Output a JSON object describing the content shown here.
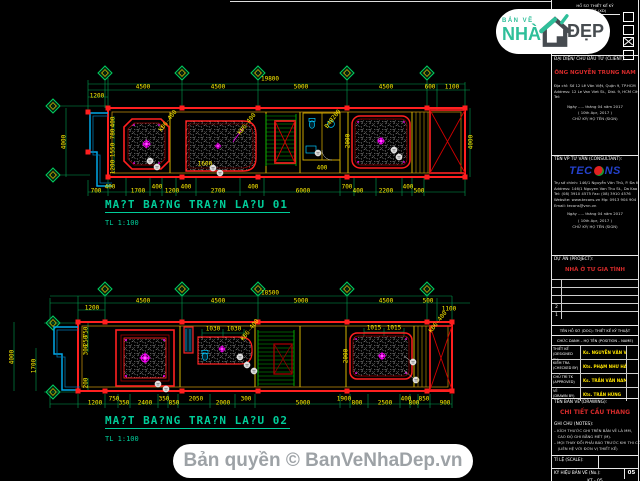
{
  "page": {
    "background": "#000000"
  },
  "colors": {
    "dim_text": "#ffef00",
    "outline_red": "#ff2020",
    "wall_yellow": "#c8a200",
    "axis_green": "#00a050",
    "title_teal": "#00cc99",
    "ornament_magenta": "#ff00ff",
    "client_red": "#d42a2a",
    "name_yellow": "#ffe400",
    "blue_cyan": "#00a8e8"
  },
  "brand": {
    "tagline": "BẢN VẼ",
    "word1": "NHÀ",
    "word2": "ĐẸP",
    "icon": "house-icon"
  },
  "banner": {
    "text": "Bản quyền © BanVeNhaDep.vn"
  },
  "plan1": {
    "title": "MA?T BA?NG TRA?N LA?U 01",
    "scale": "TL 1:100",
    "labels": [
      {
        "t": "19800",
        "x": 270,
        "y": 79
      },
      {
        "t": "4500",
        "x": 143,
        "y": 87
      },
      {
        "t": "4500",
        "x": 218,
        "y": 87
      },
      {
        "t": "5000",
        "x": 301,
        "y": 87
      },
      {
        "t": "4500",
        "x": 386,
        "y": 87
      },
      {
        "t": "600",
        "x": 430,
        "y": 87
      },
      {
        "t": "1100",
        "x": 452,
        "y": 87
      },
      {
        "t": "1200",
        "x": 97,
        "y": 96
      },
      {
        "t": "700",
        "x": 96,
        "y": 191
      },
      {
        "t": "400",
        "x": 110,
        "y": 187
      },
      {
        "t": "1700",
        "x": 138,
        "y": 191
      },
      {
        "t": "400",
        "x": 157,
        "y": 187
      },
      {
        "t": "1200",
        "x": 172,
        "y": 191
      },
      {
        "t": "400",
        "x": 186,
        "y": 187
      },
      {
        "t": "2700",
        "x": 218,
        "y": 191
      },
      {
        "t": "400",
        "x": 253,
        "y": 187
      },
      {
        "t": "6000",
        "x": 303,
        "y": 191
      },
      {
        "t": "700",
        "x": 347,
        "y": 187
      },
      {
        "t": "400",
        "x": 358,
        "y": 191
      },
      {
        "t": "2200",
        "x": 386,
        "y": 191
      },
      {
        "t": "400",
        "x": 408,
        "y": 187
      },
      {
        "t": "500",
        "x": 419,
        "y": 191
      },
      {
        "t": "4000",
        "x": 64,
        "y": 142,
        "r": -90
      },
      {
        "t": "400",
        "x": 113,
        "y": 122,
        "r": -90
      },
      {
        "t": "780",
        "x": 113,
        "y": 134,
        "r": -90
      },
      {
        "t": "1550",
        "x": 113,
        "y": 150,
        "r": -90
      },
      {
        "t": "1200",
        "x": 113,
        "y": 167,
        "r": -90
      },
      {
        "t": "2000",
        "x": 348,
        "y": 141,
        "r": -90
      },
      {
        "t": "4000",
        "x": 471,
        "y": 142,
        "r": -90
      },
      {
        "t": "1600",
        "x": 205,
        "y": 164
      },
      {
        "t": "400",
        "x": 322,
        "y": 168
      },
      {
        "t": "KĐ6-400",
        "x": 168,
        "y": 121,
        "r": -52
      },
      {
        "t": "KĐ6-400",
        "x": 247,
        "y": 124,
        "r": -52
      },
      {
        "t": "Đ4Ø200",
        "x": 333,
        "y": 119,
        "r": -52
      }
    ]
  },
  "plan2": {
    "title": "MA?T BA?NG TRA?N LA?U 02",
    "scale": "TL 1:100",
    "labels": [
      {
        "t": "18500",
        "x": 270,
        "y": 293
      },
      {
        "t": "4500",
        "x": 143,
        "y": 301
      },
      {
        "t": "4500",
        "x": 218,
        "y": 301
      },
      {
        "t": "5000",
        "x": 301,
        "y": 301
      },
      {
        "t": "4500",
        "x": 386,
        "y": 301
      },
      {
        "t": "500",
        "x": 428,
        "y": 301
      },
      {
        "t": "1100",
        "x": 449,
        "y": 309
      },
      {
        "t": "1200",
        "x": 92,
        "y": 308
      },
      {
        "t": "1030",
        "x": 213,
        "y": 329
      },
      {
        "t": "1030",
        "x": 234,
        "y": 329
      },
      {
        "t": "1015",
        "x": 374,
        "y": 328
      },
      {
        "t": "1015",
        "x": 394,
        "y": 328
      },
      {
        "t": "1200",
        "x": 95,
        "y": 403
      },
      {
        "t": "750",
        "x": 114,
        "y": 399
      },
      {
        "t": "350",
        "x": 124,
        "y": 403
      },
      {
        "t": "2400",
        "x": 145,
        "y": 403
      },
      {
        "t": "350",
        "x": 164,
        "y": 399
      },
      {
        "t": "850",
        "x": 174,
        "y": 403
      },
      {
        "t": "2050",
        "x": 196,
        "y": 399
      },
      {
        "t": "2000",
        "x": 223,
        "y": 403
      },
      {
        "t": "300",
        "x": 246,
        "y": 399
      },
      {
        "t": "5000",
        "x": 303,
        "y": 403
      },
      {
        "t": "1900",
        "x": 344,
        "y": 399
      },
      {
        "t": "800",
        "x": 357,
        "y": 403
      },
      {
        "t": "2500",
        "x": 385,
        "y": 403
      },
      {
        "t": "400",
        "x": 406,
        "y": 399
      },
      {
        "t": "800",
        "x": 414,
        "y": 403
      },
      {
        "t": "850",
        "x": 424,
        "y": 399
      },
      {
        "t": "900",
        "x": 445,
        "y": 403
      },
      {
        "t": "4000",
        "x": 12,
        "y": 357,
        "r": -90
      },
      {
        "t": "1700",
        "x": 34,
        "y": 366,
        "r": -90
      },
      {
        "t": "750",
        "x": 86,
        "y": 332,
        "r": -90
      },
      {
        "t": "250",
        "x": 86,
        "y": 341,
        "r": -90
      },
      {
        "t": "300",
        "x": 86,
        "y": 350,
        "r": -90
      },
      {
        "t": "200",
        "x": 86,
        "y": 383,
        "r": -90
      },
      {
        "t": "2000",
        "x": 346,
        "y": 356,
        "r": -90
      },
      {
        "t": "KĐ6-400",
        "x": 250,
        "y": 330,
        "r": -52
      },
      {
        "t": "KĐ6-400",
        "x": 438,
        "y": 322,
        "r": -52
      }
    ]
  },
  "titleblock": {
    "top_cell": "HỒ SƠ THIẾT KẾ KỸ THUẬT (XD)",
    "phases": [
      {
        "checked": false
      },
      {
        "checked": false
      },
      {
        "checked": true
      },
      {
        "checked": false
      }
    ],
    "client": {
      "header": "ĐẠI DIỆN/ CHỦ ĐẦU TƯ (CLIENT):",
      "name": "ÔNG NGUYỄN TRUNG NAM",
      "addr1": "Địa chỉ: Số 12 Lê Văn Việt, Quận 9, TP.HCM",
      "addr2": "Address: 12 Le Van Viet St., Dist. 9, HCM City",
      "tel": "Tel:",
      "date1": "Ngày ..... tháng 04 năm 2017",
      "date2": "( 10th Apr, 2017 )",
      "sign": "CHỮ KÝ/ HỌ TÊN (SIGN)"
    },
    "consultant": {
      "header": "TÊN VP TƯ VẤN (CONSULTANT):",
      "logo_a": "TEC",
      "logo_b": "NS",
      "addr1": "Trụ sở chính: 146/1 Nguyễn Văn Thủ, P. Đa Kao, Q.1, TP.HCM",
      "addr2": "Address: 146/1 Nguyen Van Thu St., Da Kao Ward, Dist.1, HCMC",
      "addr3": "Tel: (08) 3910 4575        Fax: (08) 3910 4576",
      "addr4": "Website: www.tecons.vn    Mp: 0913 904 904",
      "addr5": "Email: tecons@vnn.vn",
      "date1": "Ngày ..... tháng 04 năm 2017",
      "date2": "( 10th Apr, 2017 )",
      "sign": "CHỮ KÝ/ HỌ TÊN (SIGN)"
    },
    "project": {
      "header": "DỰ ÁN (PROJECT):",
      "name": "NHÀ Ở TƯ GIA TÌNH",
      "rev_rows": [
        "",
        "",
        "",
        "2",
        "1"
      ]
    },
    "team": {
      "header1": "TÊN HỒ SƠ (DOC): THIẾT KẾ KỸ THUẬT",
      "header2": "CHỨC DANH – HỌ TÊN (POSITION – NAME)",
      "rows": [
        {
          "label": "THIẾT KẾ",
          "label_en": "(DESIGNED BY)",
          "name": "Ks. NGUYỄN VĂN VIỆT"
        },
        {
          "label": "KIỂM TRA",
          "label_en": "(CHECKED BY)",
          "name": "Kts. PHẠM NHƯ HẢI"
        },
        {
          "label": "CHỦ TRÌ TK",
          "label_en": "(APPROVED)",
          "name": "Ks. TRẦN VĂN NAM"
        },
        {
          "label": "VẼ",
          "label_en": "(DRAWN BY)",
          "name": "Kts. TRẦN HÙNG"
        }
      ]
    },
    "drawing": {
      "header": "TÊN BẢN VẼ (DRAWING):",
      "name": "CHI TIẾT CẦU THANG",
      "notes_header": "GHI CHÚ (NOTES):",
      "notes": [
        "– KÍCH THƯỚC GHI TRÊN BẢN VẼ LÀ MM,",
        "   CAO ĐỘ GHI BẰNG MÉT (M).",
        "– MỌI THAY ĐỔI PHẢI BÁO TRƯỚC KHI THI CÔNG,",
        "   (LIÊN HỆ VỚI ĐƠN VỊ THIẾT KẾ)"
      ],
      "scale_label": "TỈ LỆ (SCALE):",
      "no_label": "KÝ HIỆU BẢN VẼ (No.):",
      "no_value": "KT - 05",
      "sheet_no": "05"
    }
  }
}
